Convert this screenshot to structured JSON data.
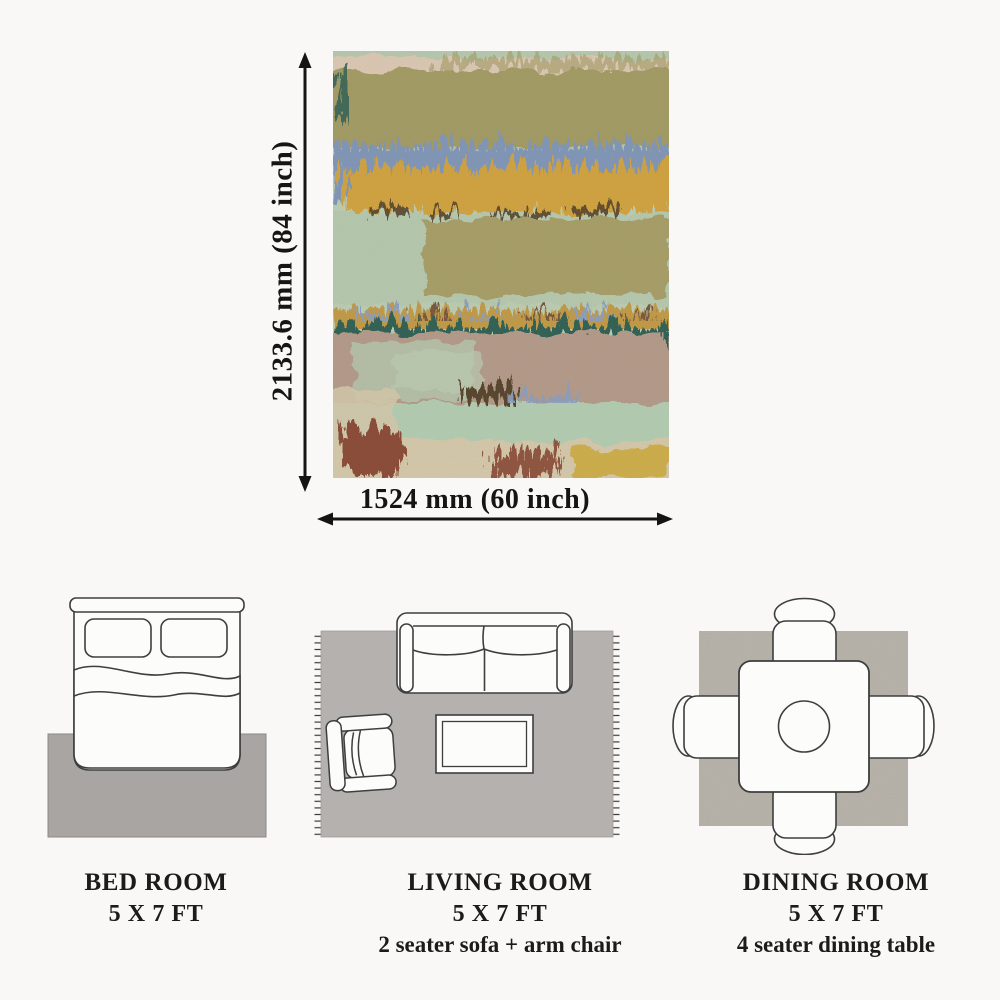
{
  "dimensions": {
    "height_label": "2133.6 mm (84 inch)",
    "width_label": "1524 mm (60 inch)"
  },
  "rooms": [
    {
      "name": "BED ROOM",
      "size": "5 X 7 FT",
      "note": ""
    },
    {
      "name": "LIVING ROOM",
      "size": "5 X 7 FT",
      "note": "2 seater sofa + arm chair"
    },
    {
      "name": "DINING ROOM",
      "size": "5 X 7 FT",
      "note": "4 seater dining table"
    }
  ],
  "rug_art": {
    "palette": {
      "sage_green": "#b6c9ae",
      "light_mint": "#bcceb4",
      "khaki_olive": "#a39b63",
      "dusty_blue": "#8095b8",
      "mustard_gold": "#d2a33e",
      "dark_teal": "#2d5e52",
      "mauve_tan": "#b49a89",
      "beige": "#d6c9ab",
      "maroon": "#8a4a36",
      "blush_pink": "#e4c9b6",
      "dark_brown": "#54432a"
    }
  },
  "colors": {
    "background": "#f9f8f7",
    "text": "#1b1b1b",
    "arrow": "#141414",
    "bedroom_rug_gray": "#a8a5a2",
    "living_rug_gray": "#b4b1ae",
    "dining_rug_gray": "#b9b4ac",
    "furniture_fill": "#fcfcfb",
    "furniture_outline": "#3e3e3e"
  }
}
